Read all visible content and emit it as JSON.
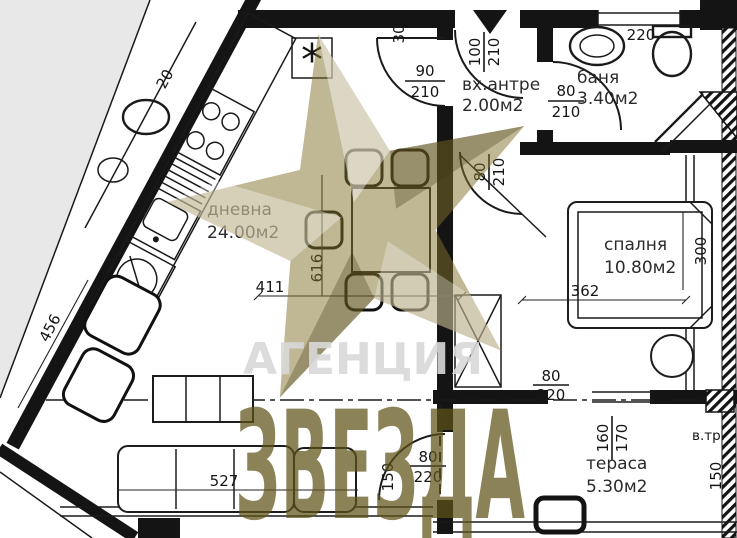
{
  "watermark": {
    "agency_line": "АГЕНЦИЯ",
    "brand_line": "ЗВЕЗДА",
    "star_color": "#82702a",
    "brand_color": "#5f5319",
    "agency_color": "#d9d9d9"
  },
  "rooms": {
    "living": {
      "name": "дневна",
      "area": "24.00м2"
    },
    "entry": {
      "name": "вх.антре",
      "area": "2.00м2"
    },
    "bath": {
      "name": "баня",
      "area": "3.40м2"
    },
    "bedroom": {
      "name": "спалня",
      "area": "10.80м2"
    },
    "terrace": {
      "name": "тераса",
      "area": "5.30м2"
    },
    "vent_label": "в.тр."
  },
  "doors": {
    "entry": {
      "w": "100",
      "h": "210"
    },
    "living": {
      "w": "90",
      "h": "210"
    },
    "bath": {
      "w": "80",
      "h": "210"
    },
    "bedroom": {
      "w": "80",
      "h": "210"
    },
    "bedroom_terrace": {
      "w": "80",
      "h": "220"
    },
    "living_terrace": {
      "w": "80",
      "h": "220"
    }
  },
  "windows": {
    "bath_window": "220",
    "terrace_window": {
      "w": "160",
      "h": "170"
    },
    "terrace_side": "150",
    "living_side": "150"
  },
  "lengths": {
    "living_width": "411",
    "living_depth": "616",
    "diagonal_wall": "456",
    "sofa_wall": "527",
    "bedroom_width": "362",
    "bedroom_depth": "300",
    "wall_niche": "30",
    "counter": "20"
  },
  "symbols": {
    "boiler": "*"
  }
}
